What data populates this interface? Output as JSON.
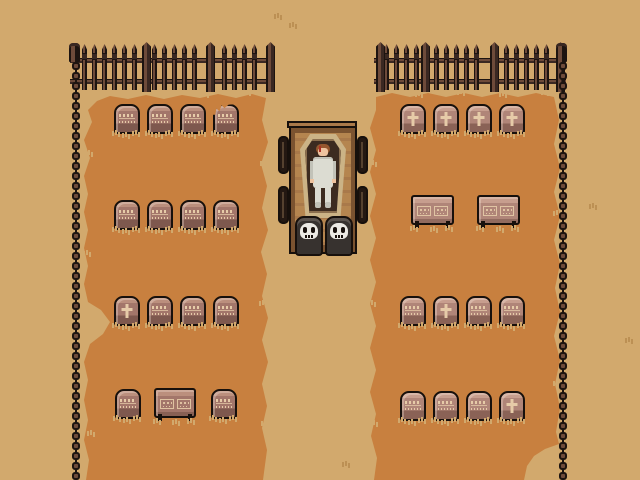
{
  "palette": {
    "bg": "#d2a96d",
    "grass": "#c8803f",
    "ink": "#17100c",
    "fenceDark": "#1d1410",
    "fenceMid": "#3a2822",
    "fenceLight": "#6e4b3a",
    "stoneLTop": "#bb8f7d",
    "stoneLBody": "#a3766a",
    "stoneLDark": "#7e584e",
    "stoneRTop": "#c79e8e",
    "stoneRBody": "#b08578",
    "stoneRDark": "#8a6256",
    "insCol": "#e6cba8",
    "tuftTan": "#d2a96d",
    "tuftDark": "#bc9054",
    "wood": "#a9794a",
    "woodDark": "#7b5330",
    "woodLight": "#b5854f",
    "wheel": "#241812",
    "wheelHub": "#55412f",
    "bone": "#cbb386",
    "coffinInner": "#3c2b20",
    "coffinRim": "#8a6e4e",
    "suit": "#dcdcd2",
    "suitShade": "#c2c2b8",
    "skin": "#eec39f",
    "hair": "#96572e",
    "blood": "#ac3026",
    "skullBody": "#37322f",
    "skullHi": "#5a534e",
    "skullFace": "#eceae4"
  },
  "scene": {
    "description": "Top-down pixel-art graveyard: hearse cart with open coffin and corpse, pulled by two skull creatures, on a path between two grass burial fields ringed by an iron fence",
    "fence": {
      "y": 43,
      "top_segments": [
        {
          "x1": 70,
          "x2": 273,
          "picket_start": 12,
          "posts": [
            142,
            206,
            266
          ]
        },
        {
          "x1": 374,
          "x2": 566,
          "picket_start": 10,
          "posts": [
            2,
            47,
            116,
            182
          ]
        }
      ],
      "corners": [
        {
          "x": 69
        },
        {
          "x": 556
        }
      ],
      "side_chains": [
        {
          "x": 72
        },
        {
          "x": 559
        }
      ],
      "chain_y1": 62,
      "chain_y2": 476,
      "bead_spacing": 10
    },
    "graves": [
      {
        "field": "left",
        "x": 114,
        "y": 104,
        "glyph": "text"
      },
      {
        "field": "left",
        "x": 147,
        "y": 104,
        "glyph": "text"
      },
      {
        "field": "left",
        "x": 180,
        "y": 104,
        "glyph": "text"
      },
      {
        "field": "left",
        "x": 213,
        "y": 104,
        "glyph": "text",
        "cracked": true
      },
      {
        "field": "left",
        "x": 114,
        "y": 200,
        "glyph": "text"
      },
      {
        "field": "left",
        "x": 147,
        "y": 200,
        "glyph": "text"
      },
      {
        "field": "left",
        "x": 180,
        "y": 200,
        "glyph": "text"
      },
      {
        "field": "left",
        "x": 213,
        "y": 200,
        "glyph": "text"
      },
      {
        "field": "left",
        "x": 114,
        "y": 296,
        "glyph": "cross"
      },
      {
        "field": "left",
        "x": 147,
        "y": 296,
        "glyph": "text"
      },
      {
        "field": "left",
        "x": 180,
        "y": 296,
        "glyph": "text"
      },
      {
        "field": "left",
        "x": 213,
        "y": 296,
        "glyph": "text"
      },
      {
        "field": "left",
        "x": 115,
        "y": 389,
        "glyph": "text"
      },
      {
        "field": "left",
        "x": 211,
        "y": 389,
        "glyph": "text"
      },
      {
        "field": "right",
        "x": 400,
        "y": 104,
        "glyph": "cross"
      },
      {
        "field": "right",
        "x": 433,
        "y": 104,
        "glyph": "cross"
      },
      {
        "field": "right",
        "x": 466,
        "y": 104,
        "glyph": "cross"
      },
      {
        "field": "right",
        "x": 499,
        "y": 104,
        "glyph": "cross"
      },
      {
        "field": "right",
        "x": 400,
        "y": 296,
        "glyph": "text"
      },
      {
        "field": "right",
        "x": 433,
        "y": 296,
        "glyph": "cross"
      },
      {
        "field": "right",
        "x": 466,
        "y": 296,
        "glyph": "text"
      },
      {
        "field": "right",
        "x": 499,
        "y": 296,
        "glyph": "text"
      },
      {
        "field": "right",
        "x": 400,
        "y": 391,
        "glyph": "text"
      },
      {
        "field": "right",
        "x": 433,
        "y": 391,
        "glyph": "text"
      },
      {
        "field": "right",
        "x": 466,
        "y": 391,
        "glyph": "text"
      },
      {
        "field": "right",
        "x": 499,
        "y": 391,
        "glyph": "cross"
      }
    ],
    "stone_w": 26,
    "stone_h": 30,
    "monuments": [
      {
        "field": "left",
        "x": 154,
        "y": 388,
        "w": 42,
        "h": 30
      },
      {
        "field": "right",
        "x": 411,
        "y": 195,
        "w": 43,
        "h": 30
      },
      {
        "field": "right",
        "x": 477,
        "y": 195,
        "w": 43,
        "h": 30
      }
    ],
    "tufts": [
      {
        "x": 277,
        "y": 13,
        "on": "bg"
      },
      {
        "x": 292,
        "y": 22,
        "on": "bg"
      },
      {
        "x": 592,
        "y": 203,
        "on": "bg"
      },
      {
        "x": 628,
        "y": 337,
        "on": "bg"
      },
      {
        "x": 345,
        "y": 461,
        "on": "bg"
      },
      {
        "x": 120,
        "y": 91,
        "on": "grass"
      },
      {
        "x": 162,
        "y": 89,
        "on": "grass"
      },
      {
        "x": 204,
        "y": 91,
        "on": "grass"
      },
      {
        "x": 246,
        "y": 89,
        "on": "grass"
      },
      {
        "x": 418,
        "y": 91,
        "on": "grass"
      },
      {
        "x": 460,
        "y": 89,
        "on": "grass"
      },
      {
        "x": 502,
        "y": 91,
        "on": "grass"
      },
      {
        "x": 544,
        "y": 89,
        "on": "grass"
      },
      {
        "x": 88,
        "y": 150,
        "on": "grass"
      },
      {
        "x": 86,
        "y": 250,
        "on": "grass"
      },
      {
        "x": 90,
        "y": 430,
        "on": "grass"
      },
      {
        "x": 263,
        "y": 160,
        "on": "grass"
      },
      {
        "x": 262,
        "y": 300,
        "on": "grass"
      },
      {
        "x": 264,
        "y": 420,
        "on": "grass"
      },
      {
        "x": 372,
        "y": 160,
        "on": "grass"
      },
      {
        "x": 371,
        "y": 300,
        "on": "grass"
      },
      {
        "x": 373,
        "y": 420,
        "on": "grass"
      },
      {
        "x": 556,
        "y": 210,
        "on": "grass"
      },
      {
        "x": 556,
        "y": 380,
        "on": "grass"
      }
    ],
    "hearse": {
      "contents": "open coffin with corpse in white suit",
      "pullers": [
        "skull-creature",
        "skull-creature"
      ]
    }
  }
}
